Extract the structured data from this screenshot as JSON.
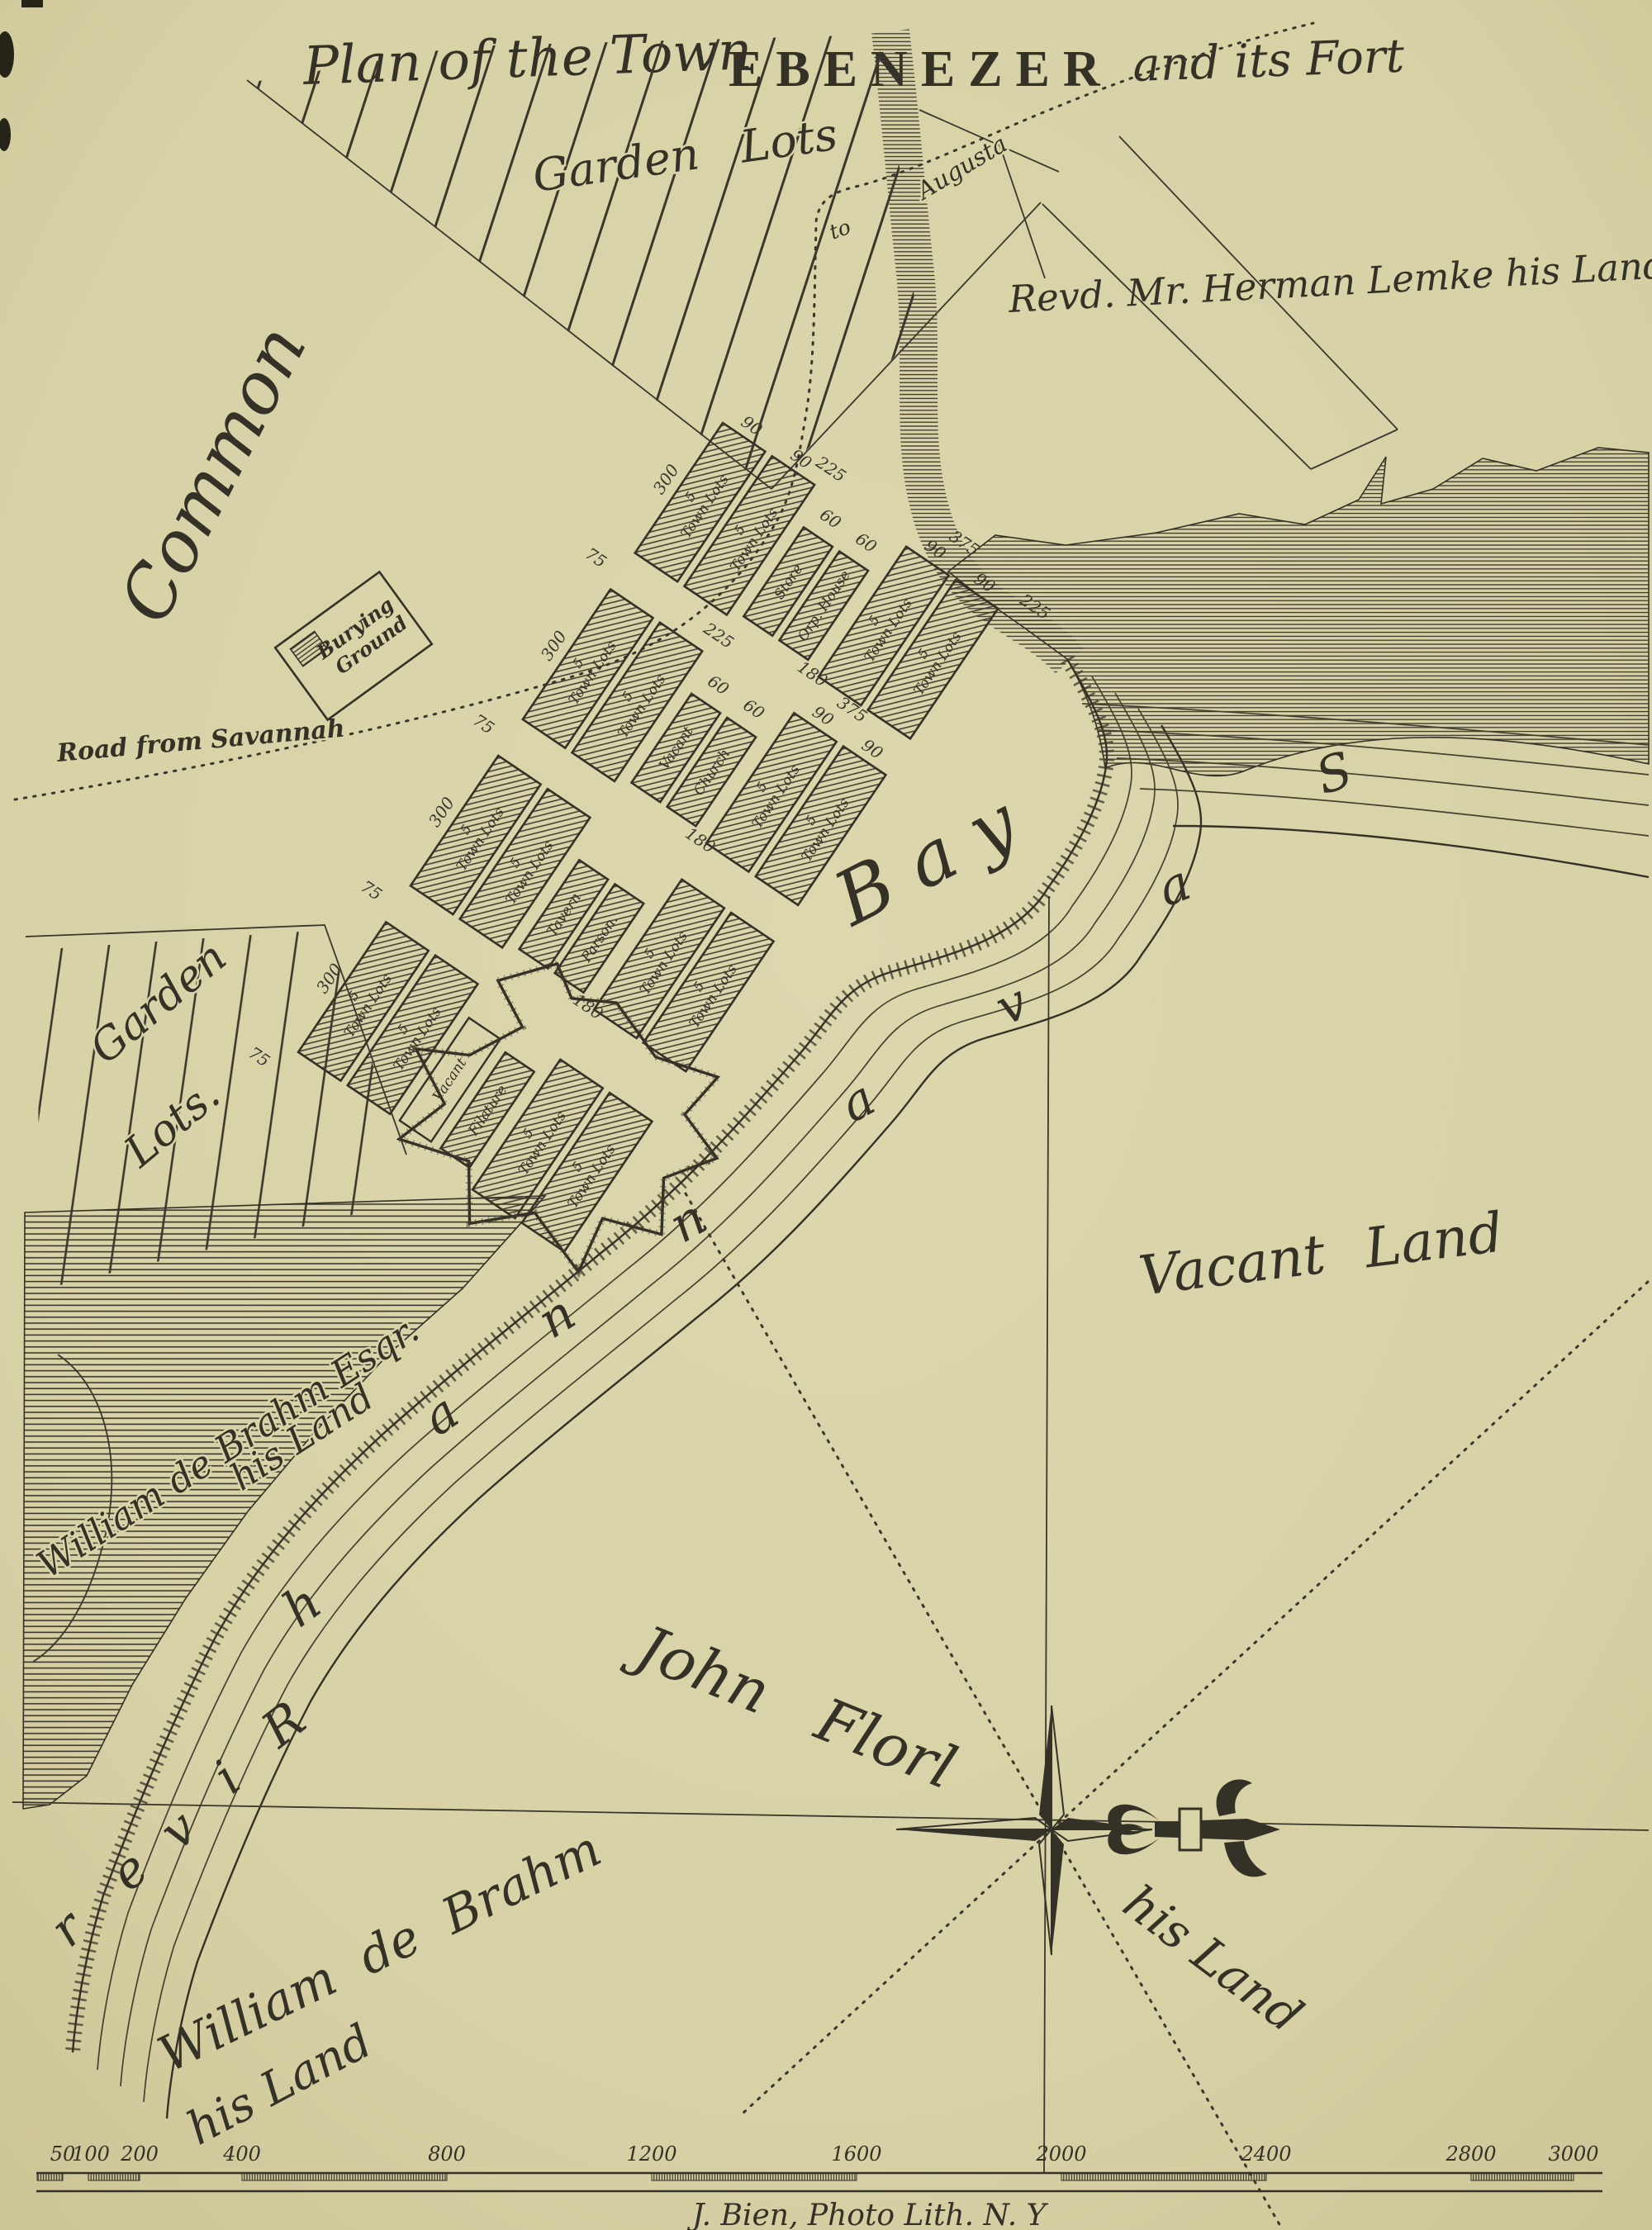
{
  "page": {
    "bg": "#d9d3a8",
    "ink": "#343127"
  },
  "title": {
    "prefix": "Plan of the Town",
    "main": "EBENEZER",
    "suffix": "and its Fort"
  },
  "regions": {
    "garden_lots_top": "Garden Lots",
    "garden_bottom_1": "Garden",
    "garden_bottom_2": "Lots.",
    "common": "Common",
    "bay": "Bay",
    "vacant_land": "Vacant Land",
    "lemke": "Revd. Mr. Herman Lemke his Land",
    "john_florl": "John Florl",
    "florl_his_land": "his Land",
    "de_brahm_esq_1": "William de Brahm Esqr.",
    "de_brahm_esq_2": "his Land",
    "de_brahm_1": "William de Brahm",
    "de_brahm_2": "his Land",
    "burying_1": "Burying",
    "burying_2": "Ground",
    "road_savannah": "Road from Savannah",
    "to": "to",
    "augusta": "Augusta"
  },
  "river": {
    "letters": [
      "S",
      "a",
      "v",
      "a",
      "n",
      "n",
      "a",
      "h",
      "R",
      "i",
      "v",
      "e",
      "r"
    ]
  },
  "town": {
    "five": "5",
    "town_lots": "Town Lots",
    "store": "Store",
    "orp_house": "Orp. House",
    "vacant": "Vacant",
    "church": "Church",
    "tavern": "Tavern",
    "parson": "Parson.",
    "filature": "Filature",
    "dims": {
      "d300": "300",
      "d75": "75",
      "d90": "90",
      "d225": "225",
      "d60": "60",
      "d180": "180",
      "d375": "375"
    }
  },
  "scale": {
    "ticks": [
      "50",
      "100",
      "200",
      "400",
      "800",
      "1200",
      "1600",
      "2000",
      "2400",
      "2800",
      "3000"
    ]
  },
  "imprint": "J. Bien, Photo Lith. N. Y"
}
